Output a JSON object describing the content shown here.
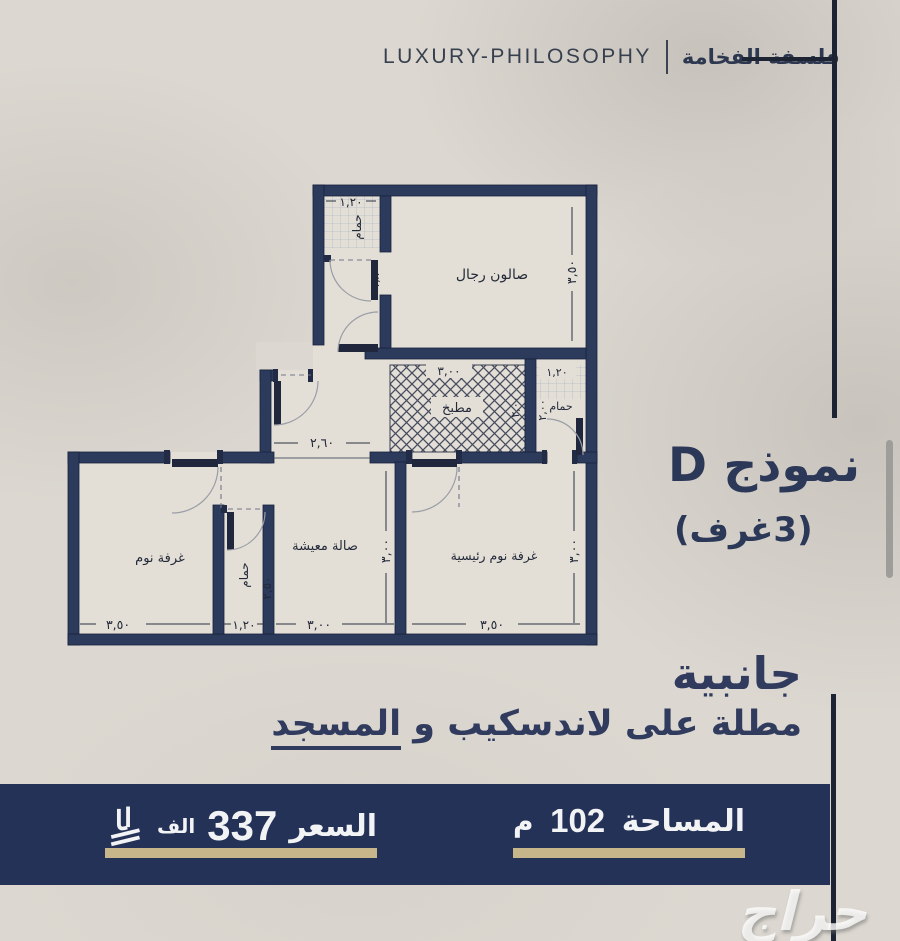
{
  "header": {
    "brand_en": "LUXURY-PHILOSOPHY",
    "brand_ar": "فلسفة الفخامة"
  },
  "model": {
    "name": "نموذج D",
    "rooms_count": "(3غرف)"
  },
  "description": {
    "line1": "جانبية",
    "line2_prefix": "مطلة على لاندسكيب و ",
    "line2_underlined": "المسجد"
  },
  "footer": {
    "price": {
      "label": "السعر",
      "value": "337",
      "unit": "الف",
      "currency_icon": "saudi-riyal-symbol"
    },
    "area": {
      "label": "المساحة",
      "value": "102",
      "unit": "م"
    }
  },
  "watermark": {
    "text": "حراج"
  },
  "plan": {
    "rooms": {
      "bath_top": "حمام",
      "salon": "صالون رجال",
      "kitchen": "مطبخ",
      "bath_right": "حمام",
      "bedroom": "غرفة نوم",
      "bath_mid": "حمام",
      "living": "صالة معيشة",
      "master": "غرفة نوم رئيسية"
    },
    "dims": {
      "bath_top_w": "١,٢٠",
      "bath_top_h": "١,٨٠",
      "salon_h": "٣,٥٠",
      "kitchen_w": "٣,٠٠",
      "kitchen_h": "٢,٠٠",
      "bath_right_w": "١,٢٠",
      "bath_right_h": "٢,٠٠",
      "hall_w": "٢,٦٠",
      "bedroom_w": "٣,٥٠",
      "bath_mid_w": "١,٢٠",
      "bath_mid_h": "٢,٥٠",
      "living_w": "٣,٠٠",
      "living_h": "٣,٠٠",
      "master_w": "٣,٥٠",
      "master_h": "٣,٠٠"
    }
  },
  "colors": {
    "navy_wall": "#2c3a5c",
    "footer_bar": "#253257",
    "gold": "#c7b68a",
    "text_navy": "#2c3857",
    "background": "#dcd8d1"
  }
}
